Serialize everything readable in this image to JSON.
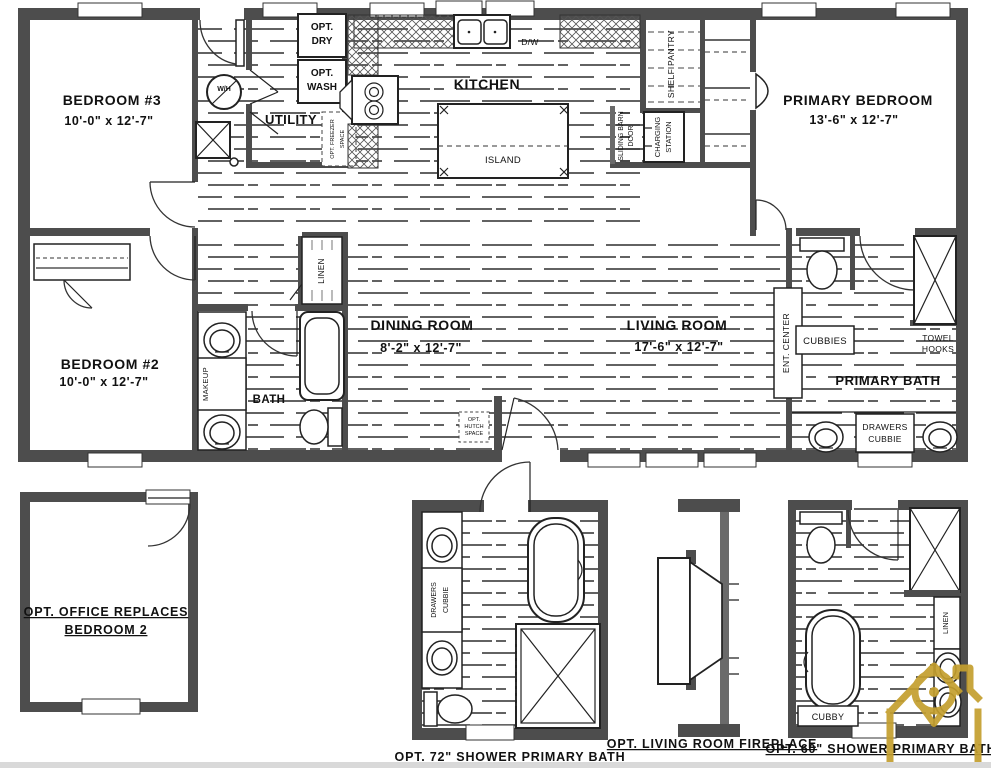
{
  "plan": {
    "bedroom3": {
      "name": "BEDROOM #3",
      "dims": "10'-0\" x  12'-7\""
    },
    "bedroom2": {
      "name": "BEDROOM #2",
      "dims": "10'-0\" x  12'-7\""
    },
    "primary_bedroom": {
      "name": "PRIMARY BEDROOM",
      "dims": "13'-6\" x  12'-7\""
    },
    "kitchen": {
      "name": "KITCHEN",
      "island": "ISLAND",
      "dw": "D/W"
    },
    "utility": {
      "name": "UTILITY",
      "opt_dry_1": "OPT.",
      "opt_dry_2": "DRY",
      "opt_wash_1": "OPT.",
      "opt_wash_2": "WASH",
      "water_heater": "W/H",
      "opt_freezer_1": "OPT. FREEZER",
      "opt_freezer_2": "SPACE"
    },
    "pantry": {
      "label": "SHELF PANTRY"
    },
    "barn_door": {
      "line1": "SLIDING BARN",
      "line2": "DOOR"
    },
    "charging": {
      "line1": "CHARGING",
      "line2": "STATION"
    },
    "dining": {
      "name": "DINING ROOM",
      "dims": "8'-2\" x  12'-7\""
    },
    "living": {
      "name": "LIVING ROOM",
      "dims": "17'-6\" x  12'-7\""
    },
    "ent_center": "ENT. CENTER",
    "opt_hutch": {
      "line1": "OPT.",
      "line2": "HUTCH",
      "line3": "SPACE"
    },
    "bath": {
      "name": "BATH",
      "makeup": "MAKEUP",
      "linen": "LINEN"
    },
    "primary_bath": {
      "name": "PRIMARY BATH",
      "cubbies": "CUBBIES",
      "towel_1": "TOWEL",
      "towel_2": "HOOKS",
      "drawers_1": "DRAWERS",
      "drawers_2": "CUBBIE"
    }
  },
  "details": {
    "office": {
      "caption_1": "OPT. OFFICE REPLACES",
      "caption_2": "BEDROOM 2"
    },
    "shower72": {
      "caption": "OPT. 72\" SHOWER PRIMARY BATH",
      "drawers_1": "DRAWERS",
      "drawers_2": "CUBBIE"
    },
    "fireplace": {
      "caption": "OPT. LIVING ROOM FIREPLACE"
    },
    "shower60": {
      "caption": "OPT. 60\" SHOWER PRIMARY BATH",
      "linen": "LINEN",
      "cubby": "CUBBY"
    }
  },
  "colors": {
    "wall": "#4d4d4d",
    "line": "#1a1a1a",
    "logo_gold": "#c49f2e",
    "background": "#ffffff"
  }
}
